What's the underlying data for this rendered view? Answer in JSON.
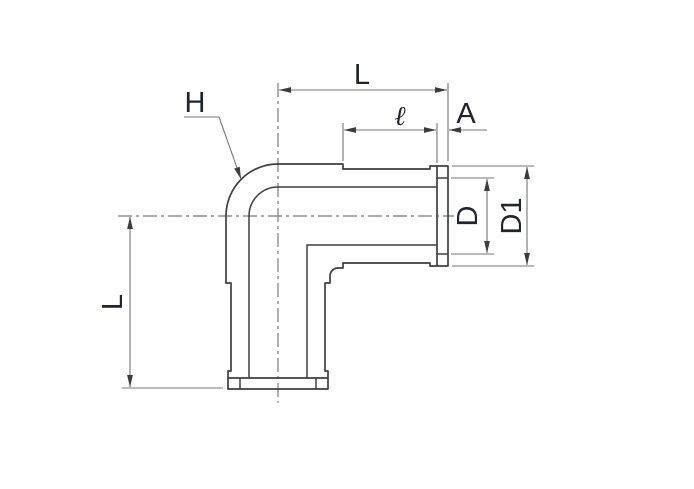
{
  "drawing": {
    "labels": {
      "length_horizontal": "L",
      "bend_reference": "H",
      "socket_length": "ℓ",
      "flange_thickness": "A",
      "tube_diameter": "D",
      "flange_outer_diameter": "D1",
      "length_vertical": "L"
    },
    "colors": {
      "outline": "#3f3f3f",
      "dimension_lines": "#757575",
      "centerlines": "#8f8f8f",
      "label_text": "#20242e",
      "arrowhead": "#3c3c3c",
      "background": "#ffffff"
    }
  }
}
